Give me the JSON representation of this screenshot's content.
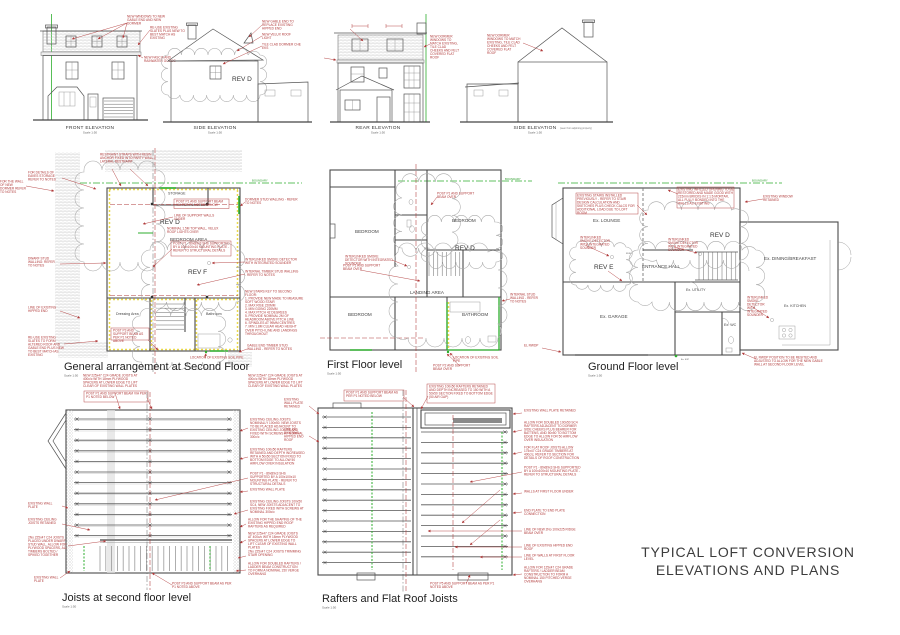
{
  "colors": {
    "red": "#b03a3a",
    "green": "#2eae2e",
    "yellow": "#e6d22e",
    "line": "#4a4a4a",
    "cloud": "#a9a9a9"
  },
  "sheet": {
    "title1": "TYPICAL LOFT CONVERSION",
    "title2": "ELEVATIONS AND PLANS",
    "scale": "Scale 1:50"
  },
  "ele": {
    "front": {
      "label": "FRONT ELEVATION",
      "n1": "NEW WINDOWS TO NEW GABLE END AND NEW DORMER",
      "n2": "RE-USE EXISTING SLATES PLUS NEW TO BEST MATCH AS EXISTING",
      "n3": "NEW FASCIA AND RAINWATER GOODS"
    },
    "sidea": {
      "label": "SIDE ELEVATION",
      "rev": "REV D",
      "n1": "NEW GABLE END TO REPLACE EXISTING HIPPED END",
      "n2": "NEW VELUX ROOF LIGHT",
      "n3": "TILE CLAD DORMER CHE EKS"
    },
    "rear": {
      "label": "REAR ELEVATION",
      "n1": "NEW DORMER WINDOWS TO MATCH EXISTING, TILE CLAD CHEEKS AND FELT COVERED FLAT ROOF"
    },
    "sideb": {
      "label": "SIDE ELEVATION",
      "sub": "(seen from adjoining property)",
      "n1": "NEW DORMER WINDOWS TO MATCH EXISTING, TILE CLAD CHEEKS AND FELT COVERED FLAT ROOF"
    }
  },
  "sf": {
    "title": "General arrangement at Second Floor",
    "boundary": "BOUNDARY",
    "storage": "STORAGE",
    "bedroom": "BEDROOM AREA",
    "dressing": "Dressing Area",
    "bathroom": "Bathroom",
    "revd": "REV D",
    "revf": "REV F",
    "n_restraint": "RESTRAINT STRAPS WITH RESIN ANCHOR FIXED INTO PARTY WALL - LATERAL RESTRAINT",
    "n_post1": "POST P1 AND SUPPORT BEAM VIA PER P1 NOTED BELOW",
    "n_supwalls": "LINE OF SUPPORT WALLS UNDER",
    "n_velux": "NOMINAL 1.5M TOP WALL, VELUX ROOF LIGHTS OVER",
    "n_post1box": "POST P1 - 89x89x3 SHS SUPPORTED BY A 100x100x10 MOUNTING PLATE - REFER TO STRUCTURAL DETAILS",
    "n_post3box": "POST P3 AND SUPPORT BEAM AS PER P1 NOTED ABOVE",
    "n_dormer": "DORMER STUD WALLING - REFER TO NOTES",
    "n_smoke": "INTERLINKED SMOKE DETECTOR WITH INTEGRATED SOUNDER",
    "n_intstud": "INTERNAL TIMBER STUD WALLING - REFER TO NOTES",
    "n_stairkey": "NEW STAIRS KEY TO SECOND FLOOR:\n1. PROVIDE NEW MADE TO MEASURE SOFT WOOD STAIR\n2. MAX RISE 220MM\n3. MIN GOING 220MM\n4. MAX PITCH 42 DEGREES\n5. PROVIDE NOMINAL 2M OF HEADROOM ABOVE PITCH LINE\n6. SPINDLES AT 99MM CENTRES\n7. MIN 1.8M CLEAR HEAD HEIGHT OVER PITCH LINE AND LANDINGS THROUGHOUT",
    "n_gable": "GABLE END TIMBER STUD WALLING - REFER TO NOTES",
    "n_soil": "LOCATION OF EXISTING SOIL PIPE",
    "n_eaves": "FOR DETAILS OF EAVES STORAGE REFER TO NOTES",
    "n_dwarf": "DWARF STUD WALLING: REFER TO NOTES",
    "n_hipped": "LINE OF EXISTING HIPPED END",
    "n_slates": "RE-USE EXISTING SLATES TO FORM ALTERED ROOF AND GABLE END PLUS NEW TO BEST MATCH AS EXISTING",
    "n_left1": "FOR THE WALL OF NEW DORMER REFER TO NOTES"
  },
  "ff": {
    "title": "First Floor level",
    "boundary": "BOUNDARY",
    "bed": "BEDROOM",
    "landing": "LANDING AREA",
    "bath": "BATHROOM",
    "revd": "REV D",
    "fd30": "FD30",
    "n_post1": "POST P1 AND SUPPORT BEAM OVER",
    "n_smoke": "INTERLINKED SMOKE DETECTOR WITH INTEGRATED SOUNDER",
    "n_post2": "POST P2 AND SUPPORT BEAM OVER",
    "n_soil": "LOCATION OF EXISTING SOIL PIPE",
    "n_intstud": "INTERNAL STUD WALLING - REFER TO NOTES"
  },
  "gf": {
    "title": "Ground Floor level",
    "boundary": "BOUNDARY",
    "lounge": "Ex. LOUNGE",
    "hall": "ENTRANCE HALL",
    "garage": "Ex. GARAGE",
    "utility": "Ex. UTILITY",
    "wc": "Ex. WC",
    "dining": "Ex. DINING/BREAKFAST",
    "kitchen": "Ex. KITCHEN",
    "svp": "Ex. SVP",
    "revd": "REV D",
    "reve": "REV E",
    "fd30": "FD30",
    "n_stairs": "EXISTING STAIRS INSTALLED PREVIOUSLY - REFER TO STAIR DESIGN CALCULATION AND SKETCHES PLUS CHECK CALCS FOR ADDITIONAL LOAD DUE TO LOFT ROOM",
    "n_infill": "EXISTING INFILLED OPENING TO BE RESTORED AND MADE GOOD WITH 215mm BRICKS IN 1:1:6 MORTAR, ALL FULLY BONDED INTO THE WALLS AS EXISTING",
    "n_window": "EXISTING WINDOW RETAINED",
    "n_smoke": "INTERLINKED SMOKE DETECTOR WITH INTEGRATED SOUNDER",
    "n_rwdp": "EL RWDP POSITION TO BE RESITED AND ADJUSTED TO ALLOW FOR THE NEW GABLE WALL AT SECOND FLOOR LEVEL",
    "n_rwdp_s": "EL RWDP"
  },
  "jo": {
    "title": "Joists at second floor level",
    "n_top": "POST P1 AND SUPPORT BEAM VIA PER P1 NOTED BELOW",
    "n_new": "NEW 225x47 C24 GRADE JOISTS AT 400c/c WITH 18mm PLYWOOD SPACERS AT LOWER EDGE TO LIFT CLEAR OF EXISTING WALL PLATES",
    "r1": "EXISTING CEILING JOISTS NOMINALLY 100x50. NEW JOISTS TO BE PLACED ADJACENT TO EXISTING CEILING JOISTS AND FIXED WITH SCREWS AT NOMINAL 300c/c",
    "r2": "EXISTING 100x50 RAFTERS RETAINED AND DEPTH INCREASED WITH A 50x50 SECTION FIXED TO BOTTOM EDGE TO ALLOW 50 AIRFLOW OVER INSULATION",
    "r3": "POST P1 - 89x89x3 SHS SUPPORTED BY A 100x100x10 MOUNTING PLATE - REFER TO STRUCTURAL DETAILS",
    "r4": "EXISTING WALL PLATE",
    "r5": "EXISTING CEILING JOISTS 100x50 SC4, NEW JOISTS ADJACENT TO EXISTING FIXED WITH SCREWS AT NOMINAL 300c/c",
    "l1": "EXISTING WALL PLATE",
    "l2": "EXISTING CEILING JOISTS RETAINED",
    "l3": "2No 225x47 C24 JOISTS PLACED UNDER DWARF STUD WALL. ALLOW FOR PLYWOOD SPACERS, ALL TIMBERS BOLTED / SPIKED TOGETHER",
    "n_bottom": "POST P3 AND SUPPORT BEAM AS PER P1 NOTED ABOVE",
    "br1": "ALLOW FOR THE SHAPING OF THE EXISTING HIPPED END ROOF RAFTERS AS REQUIRED",
    "br2": "NEW 225x47 C24 GRADE JOISTS AT 400c/c WITH 18mm PLYWOOD SPACERS AT LOWER EDGE TO LIFT CLEAR OF EXISTING WALL PLATES",
    "br3": "2No 225x47 C24 JOISTS TRIMMING STAIR OPENING",
    "br4": "ALLOW FOR DOUBLED RAFTERS / LADDER BEAM CONSTRUCTION TO FORM A NOMINAL 150 VERGE OVERHANG"
  },
  "ra": {
    "title": "Rafters and Flat Roof Joists",
    "n_top1": "POST P1 AND SUPPORT BEAM AS PER P1 NOTED BELOW",
    "n_top2": "EXISTING 100x50 RAFTERS RETAINED AND DEPTH INCREASED TO 150 WITH A 50x50 SECTION FIXED TO BOTTOM EDGE (50 AIR GAP)",
    "n_bottom": "POST P5 AND SUPPORT BEAM AS PER P1 NOTED ABOVE",
    "rr1": "EXISTING WALL PLATE RETAINED",
    "rr2": "ALLOW FOR DOUBLED 100x50 SC4 RAFTERS ADJACENT TO DORMER SIDE CHEEKS PLUS BEARER FOR BATTENS, AND 50x50 TO BOTTOM EDGE TO ALLOW FOR 50 AIRFLOW OVER INSULATION",
    "rr3": "FOR FLAT ROOF JOISTS ALLOW 175x47 C24 GRADE TIMBERS AT 400c/c, REFER TO SECTION FOR DETAILS OF ROOF CONSTRUCTION",
    "rr4": "POST P1 - 89x89x3 SHS SUPPORTED BY A 100x100x10 MOUNTING PLATE - REFER TO STRUCTURAL DETAILS",
    "rr5": "WALLS AT FIRST FLOOR UNDER",
    "rr6": "END PLATE TO END PLATE CONNECTION",
    "rr7": "LINE OF NEW 2No 100x225 RIDGE BEAM OVER",
    "rr8": "LINE OF EXISTING HIPPED END ROOF",
    "rr9": "LINE OF WALLS AT FIRST FLOOR LEVEL",
    "rr10": "ALLOW FOR 125x47 C24 GRADE RAFTERS / LADDER BEAM CONSTRUCTION TO FORM A NOMINAL 150 PITCHED VERGE OVERHANG"
  }
}
